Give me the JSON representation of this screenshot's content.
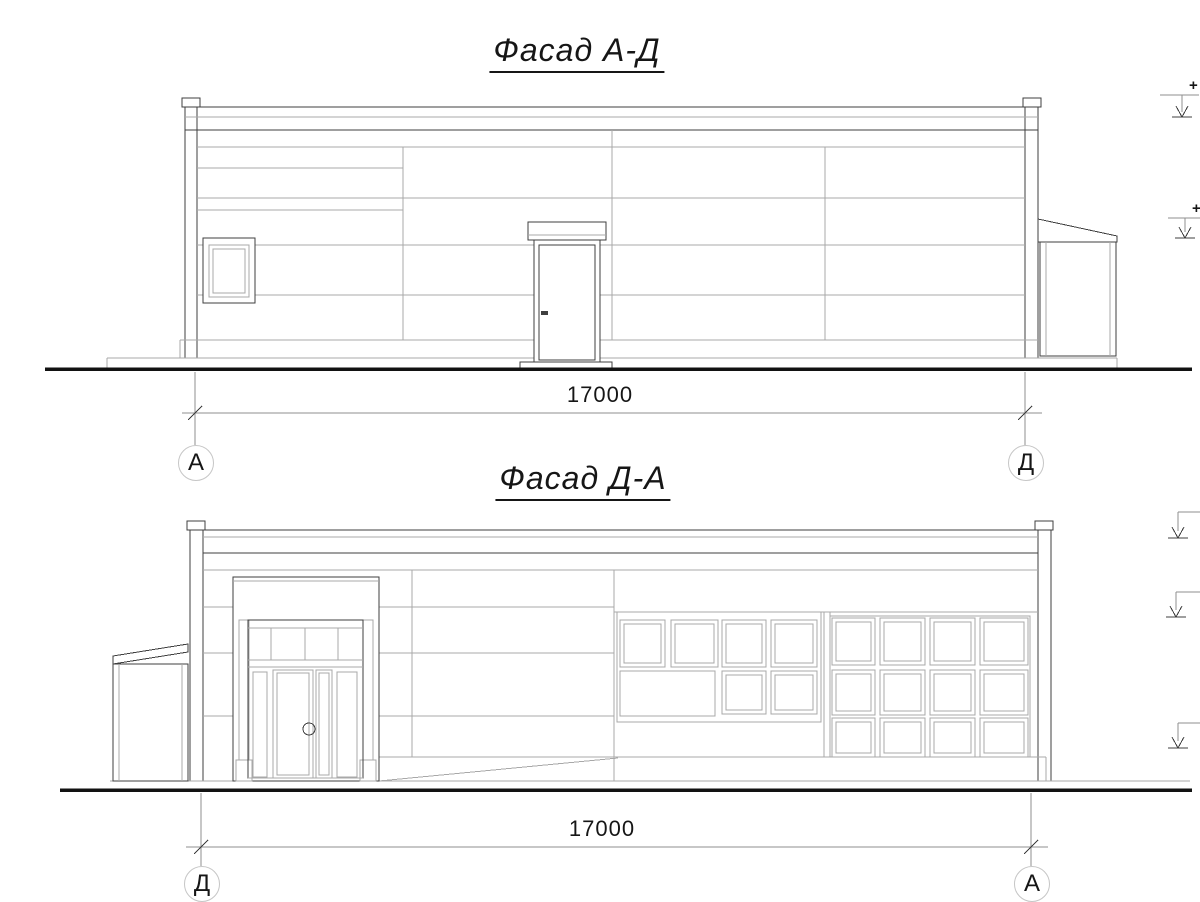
{
  "colors": {
    "background": "#ffffff",
    "line": "#3f3f3f",
    "light_line": "#a8a8a8",
    "ground": "#121212",
    "dim": "#8f8f8f",
    "circle": "#c6c6c6",
    "text": "#161616"
  },
  "facade_top": {
    "title": "Фасад А-Д",
    "dimension": "17000",
    "axis_left": "А",
    "axis_right": "Д",
    "elevation_marks": [
      {
        "label": "+"
      },
      {
        "label": "+"
      }
    ]
  },
  "facade_bottom": {
    "title": "Фасад Д-А",
    "dimension": "17000",
    "axis_left": "Д",
    "axis_right": "А"
  }
}
